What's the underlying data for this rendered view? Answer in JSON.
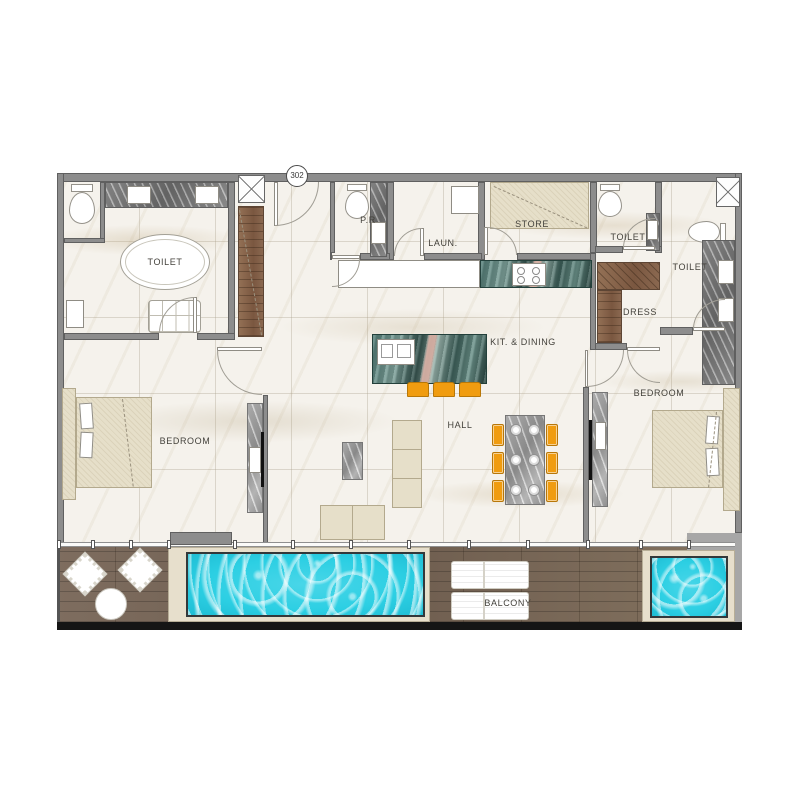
{
  "unit": {
    "number": "302"
  },
  "rooms": {
    "toilet_master": {
      "label": "TOILET"
    },
    "powder": {
      "label": "P.R"
    },
    "laundry": {
      "label": "LAUN."
    },
    "store": {
      "label": "STORE"
    },
    "toilet_guest": {
      "label": "TOILET"
    },
    "toilet_right": {
      "label": "TOILET"
    },
    "dress": {
      "label": "DRESS"
    },
    "kitchen_dining": {
      "label": "KIT. & DINING"
    },
    "hall": {
      "label": "HALL"
    },
    "bedroom_left": {
      "label": "BEDROOM"
    },
    "bedroom_right": {
      "label": "BEDROOM"
    },
    "balcony": {
      "label": "BALCONY"
    }
  },
  "colors": {
    "wall": "#8d8d8d",
    "wall_edge": "#606060",
    "floor": "#f5f2ec",
    "wood": "#8a684e",
    "deck": "#79685a",
    "pool": "#2ccfe3",
    "pool_deck": "#e7dfcc",
    "orange": "#f09c10",
    "counter_teal": "#4f7a74",
    "furniture_beige": "#e6dfc9",
    "label_ink": "#44423c",
    "slab": "#151515"
  }
}
